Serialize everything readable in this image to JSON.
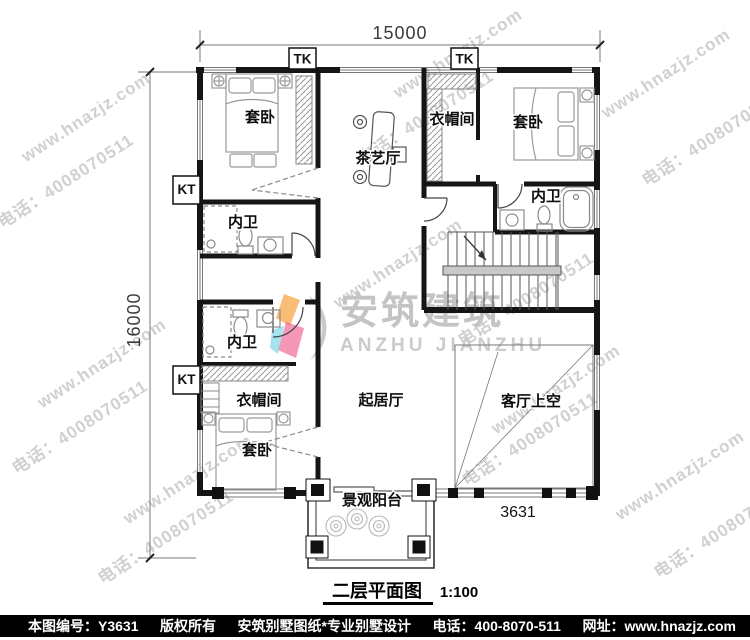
{
  "watermark": {
    "site": "www.hnazjz.com",
    "phone": "电话：4008070511"
  },
  "logo": {
    "cn": "安筑建筑",
    "en": "ANZHU JIANZHU"
  },
  "dims": {
    "width": "15000",
    "height": "16000"
  },
  "rooms": {
    "bedroom": "套卧",
    "cloakroom": "衣帽间",
    "tea_hall": "茶艺厅",
    "bathroom": "内卫",
    "living": "起居厅",
    "void": "客厅上空",
    "balcony": "景观阳台"
  },
  "marks": {
    "tk": "TK",
    "kt": "KT",
    "span": "3631"
  },
  "title": {
    "name": "二层平面图",
    "scale": "1:100"
  },
  "footer": {
    "sheet": "本图编号：Y3631",
    "copyright": "版权所有",
    "brand": "安筑别墅图纸*专业别墅设计",
    "phone": "电话：400-8070-511",
    "site": "网址：www.hnazjz.com"
  }
}
